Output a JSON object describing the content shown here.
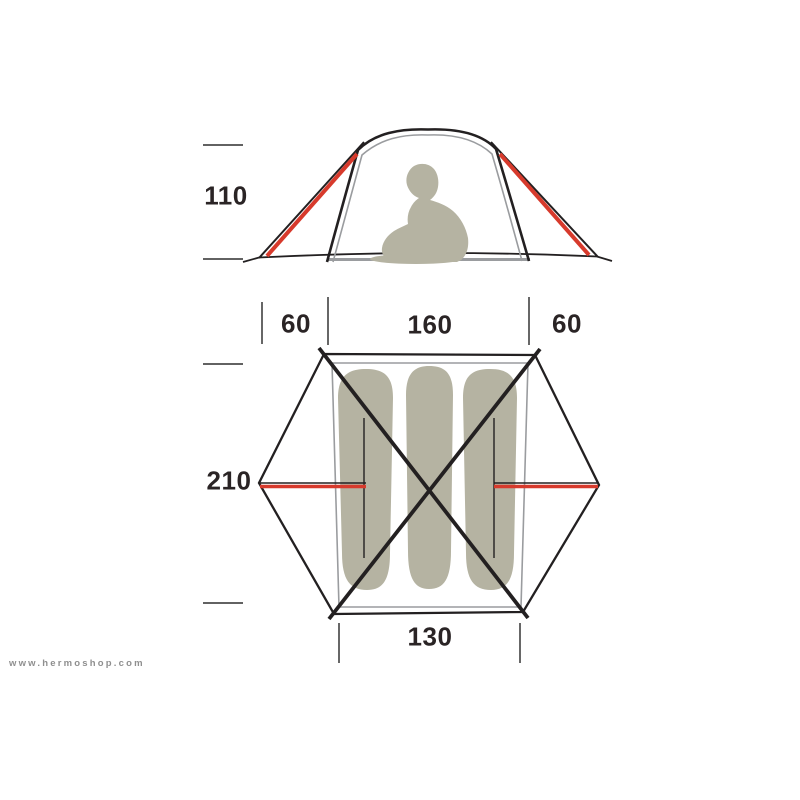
{
  "diagram": {
    "title_semantic": "tent dimensions diagram",
    "side_view": {
      "height_label": "110"
    },
    "floor_plan": {
      "vestibule_left_label": "60",
      "inner_width_label": "160",
      "vestibule_right_label": "60",
      "length_label": "210",
      "door_width_label": "130"
    }
  },
  "watermark": {
    "text": "www.hermoshop.com"
  },
  "colors": {
    "background": "#ffffff",
    "ink": "#232021",
    "red": "#d73a2c",
    "olive": "#b5b3a2",
    "gray_line": "#9a9c9f",
    "tick": "#4c4c4c",
    "label": "#2a2425",
    "watermark": "#8f8f8f"
  }
}
